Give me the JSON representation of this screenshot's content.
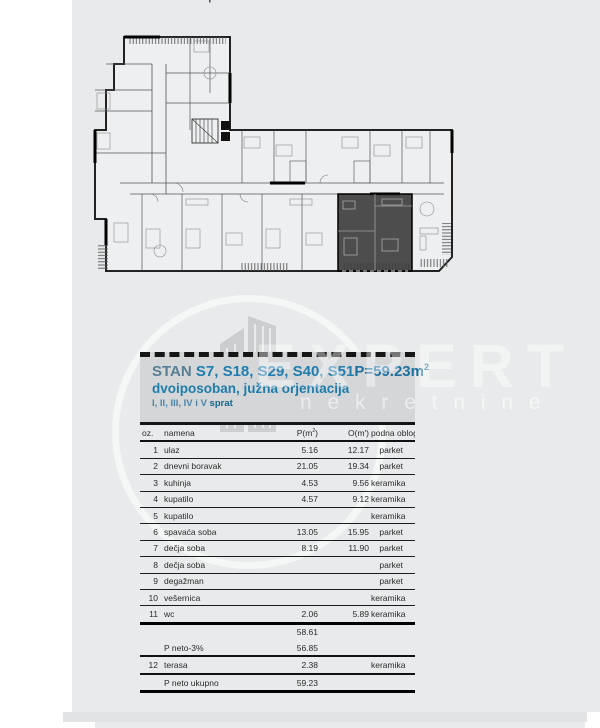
{
  "page": {
    "top_caption": "I sprat  S..  S.."
  },
  "watermark": {
    "brand": "EXPERT",
    "brand_sub": "n e k r e t n i n e"
  },
  "panel": {
    "title_stan": "STAN ",
    "title_units": "S7, S18, S29, S40, S51",
    "area_main": "P=59.23m",
    "area_sup": "2",
    "subtitle": "dvoiposoban, južna orjentacija",
    "floors": "I, II, III, IV i V ",
    "floors_word": "sprat"
  },
  "table": {
    "headers": {
      "oz": "oz.",
      "namena": "namena",
      "p_pre": "P(m",
      "p_sup": "2",
      "p_post": ")",
      "o": "O(m')",
      "floor": "podna obloga"
    },
    "rows": [
      {
        "oz": "1",
        "name": "ulaz",
        "p": "5.16",
        "o": "12.17",
        "floor": "parket"
      },
      {
        "oz": "2",
        "name": "dnevni boravak",
        "p": "21.05",
        "o": "19.34",
        "floor": "parket"
      },
      {
        "oz": "3",
        "name": "kuhinja",
        "p": "4.53",
        "o": "9.56",
        "floor": "keramika"
      },
      {
        "oz": "4",
        "name": "kupatilo",
        "p": "4.57",
        "o": "9.12",
        "floor": "keramika"
      },
      {
        "oz": "5",
        "name": "kupatilo",
        "p": "",
        "o": "",
        "floor": "keramika"
      },
      {
        "oz": "6",
        "name": "spavaća soba",
        "p": "13.05",
        "o": "15.95",
        "floor": "parket"
      },
      {
        "oz": "7",
        "name": "dečja soba",
        "p": "8.19",
        "o": "11.90",
        "floor": "parket"
      },
      {
        "oz": "8",
        "name": "dečja soba",
        "p": "",
        "o": "",
        "floor": "parket"
      },
      {
        "oz": "9",
        "name": "degažman",
        "p": "",
        "o": "",
        "floor": "parket"
      },
      {
        "oz": "10",
        "name": "vešernica",
        "p": "",
        "o": "",
        "floor": "keramika"
      },
      {
        "oz": "11",
        "name": "wc",
        "p": "2.06",
        "o": "5.89",
        "floor": "keramika"
      }
    ],
    "footer": [
      {
        "oz": "",
        "name": "",
        "p": "58.61",
        "o": "",
        "floor": ""
      },
      {
        "oz": "",
        "name": "P neto-3%",
        "p": "56.85",
        "o": "",
        "floor": ""
      },
      {
        "oz": "12",
        "name": "terasa",
        "p": "2.38",
        "o": "",
        "floor": "keramika"
      },
      {
        "oz": "",
        "name": "P neto ukupno",
        "p": "59.23",
        "o": "",
        "floor": ""
      }
    ]
  },
  "colors": {
    "page_bg": "#e9eaeb",
    "panel_bg": "#d4d6d7",
    "title_blue": "#1d7dad",
    "title_gray_blue": "#5a7e93",
    "unit_highlight": "#3b3b3b"
  }
}
